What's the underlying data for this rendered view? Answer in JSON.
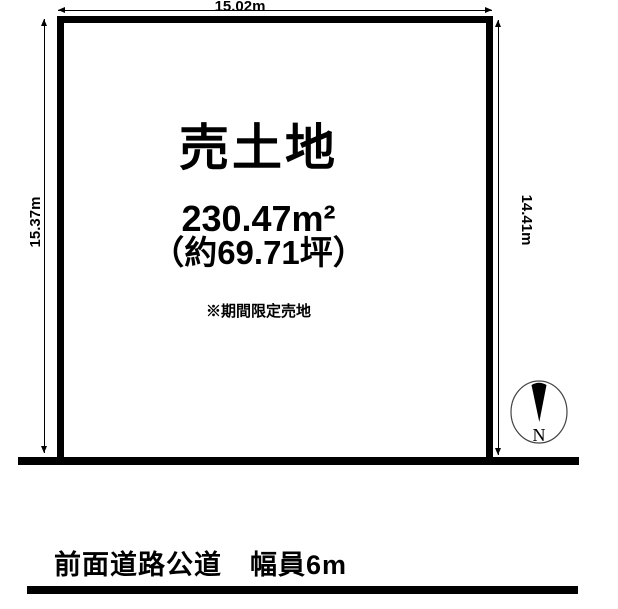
{
  "diagram": {
    "plot": {
      "title": "売土地",
      "area": "230.47m²",
      "area_tsubo": "（約69.71坪）",
      "note": "※期間限定売地"
    },
    "dimensions": {
      "top": "15.02m",
      "bottom": "14.92m",
      "left": "15.37m",
      "right": "14.41m"
    },
    "road": {
      "label": "前面道路公道　幅員6m"
    },
    "compass": {
      "north": "N"
    },
    "colors": {
      "line": "#000000",
      "background": "#ffffff"
    }
  }
}
